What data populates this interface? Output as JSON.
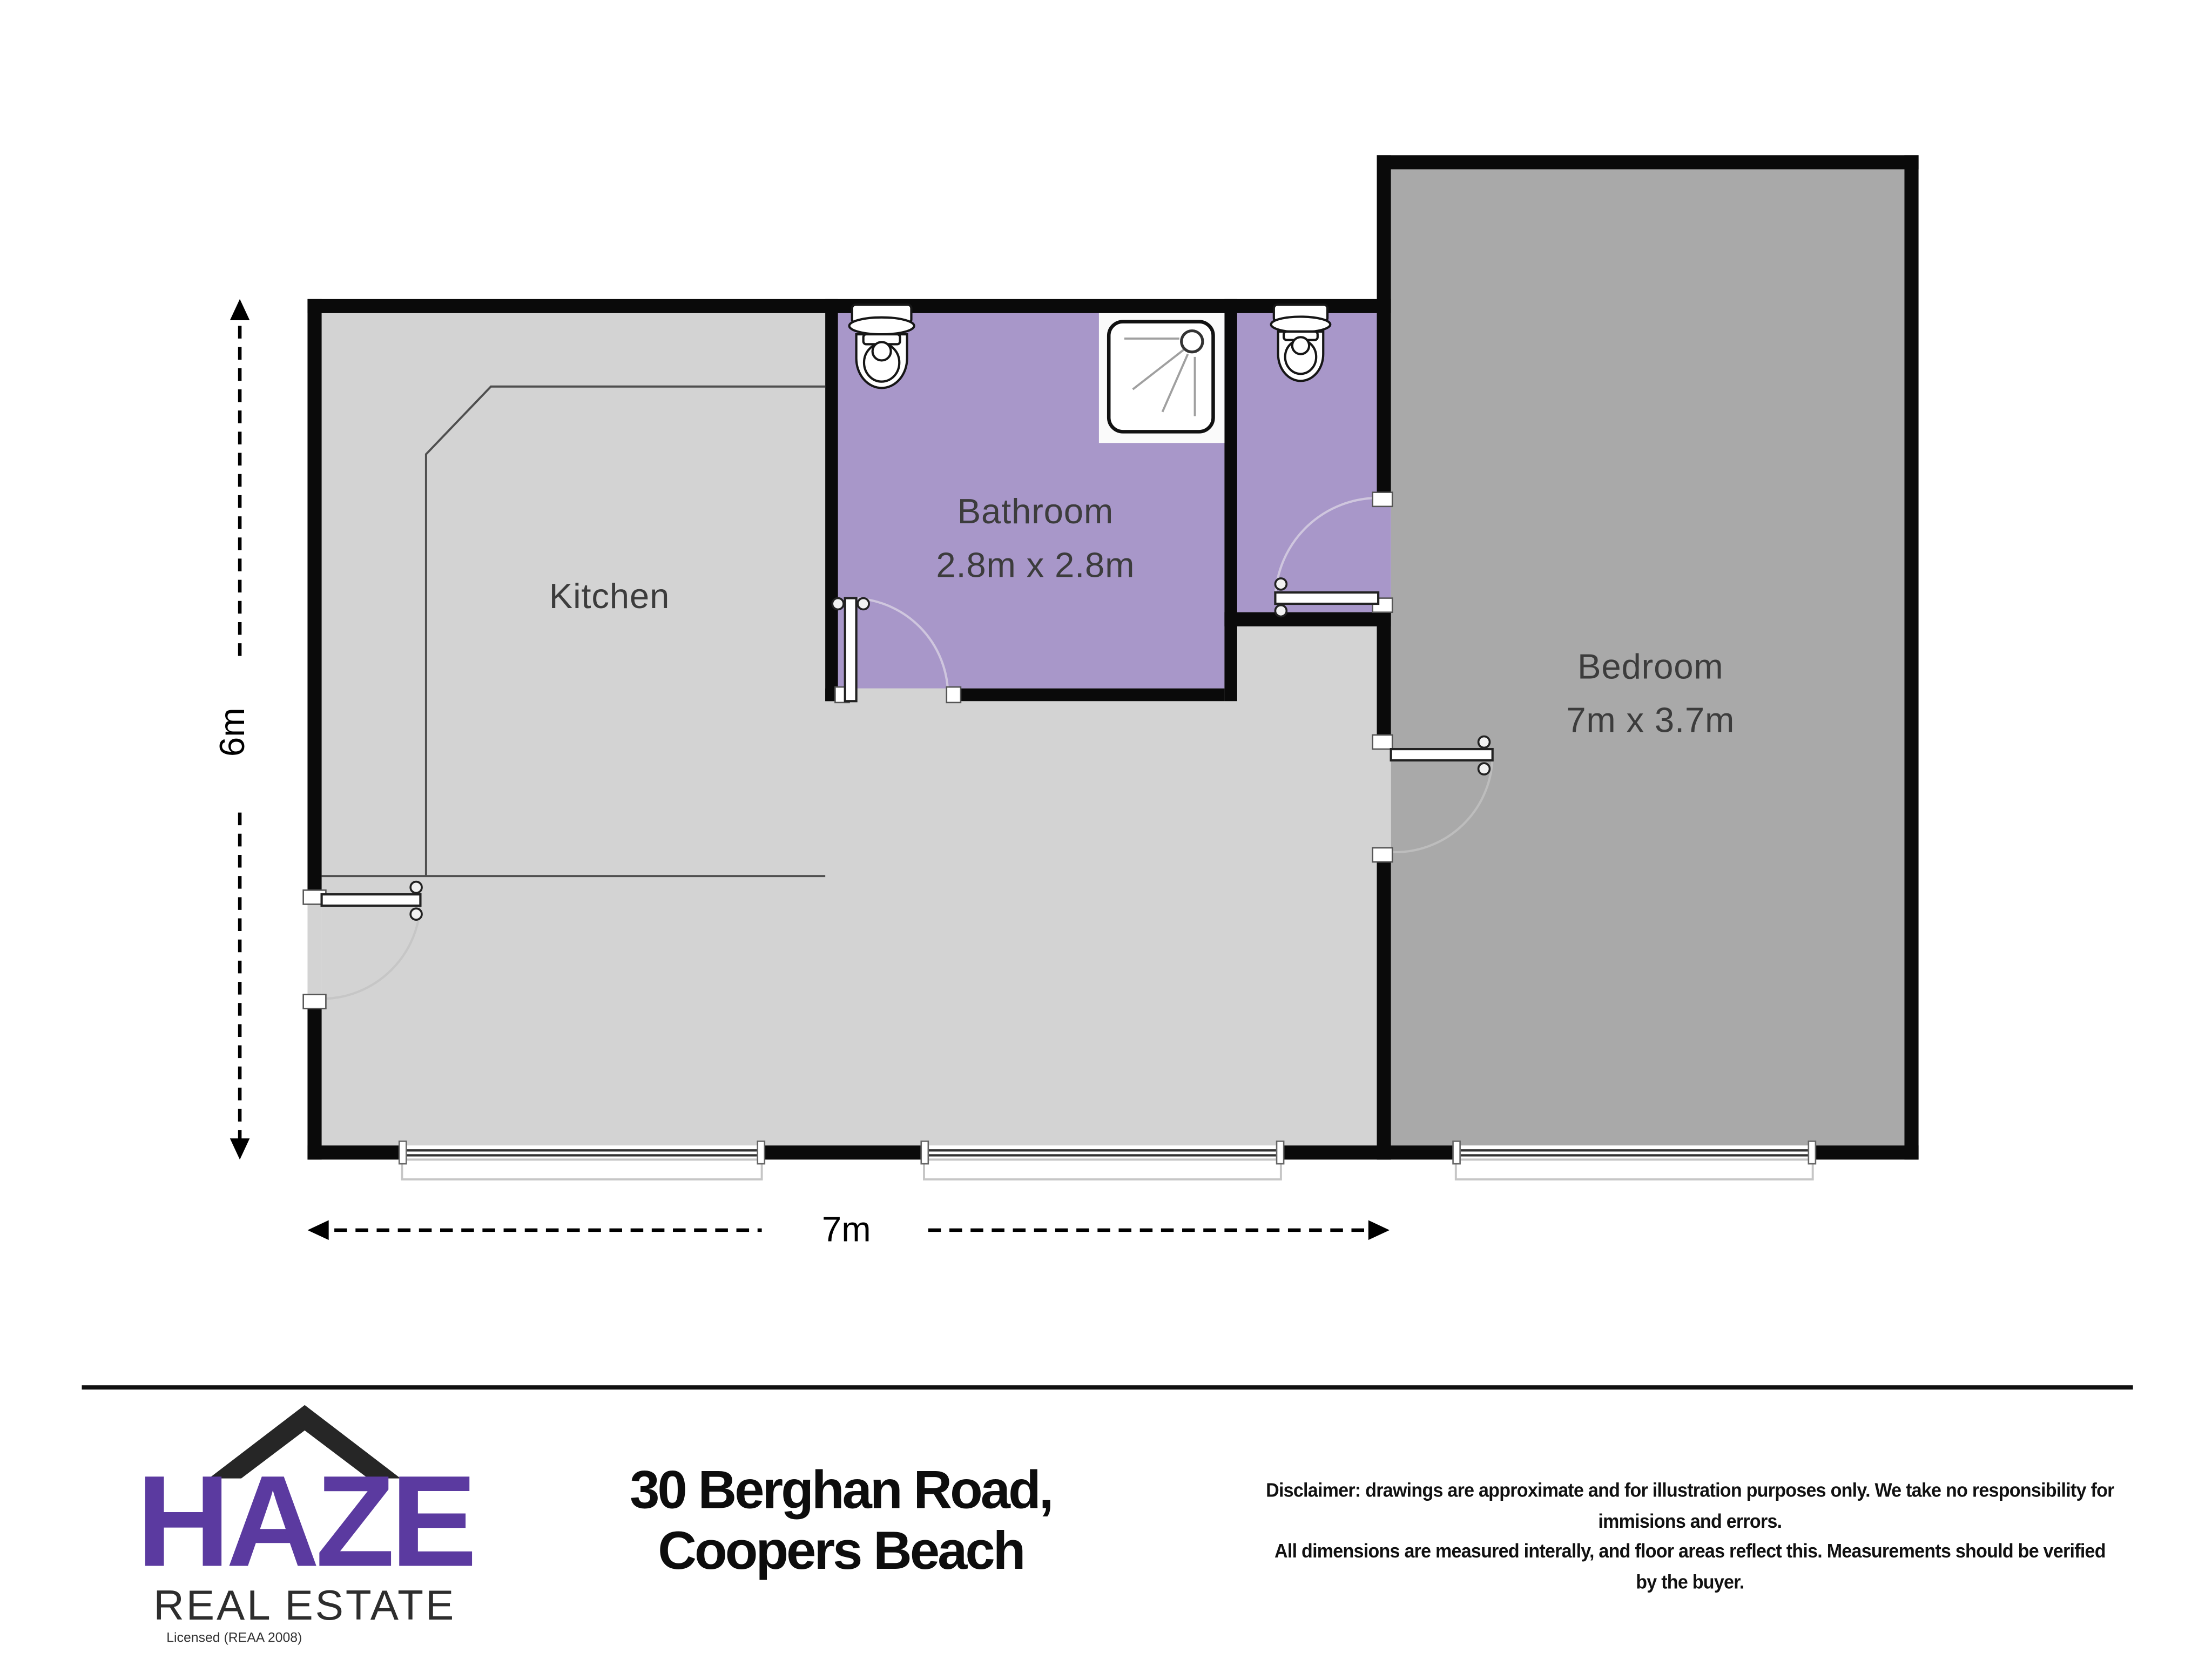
{
  "plan": {
    "rooms": [
      {
        "id": "kitchen",
        "label": "Kitchen",
        "dimensions": ""
      },
      {
        "id": "bathroom",
        "label": "Bathroom",
        "dimensions": "2.8m x 2.8m"
      },
      {
        "id": "bedroom",
        "label": "Bedroom",
        "dimensions": "7m x 3.7m"
      }
    ],
    "overall_dimensions": {
      "height_label": "6m",
      "width_label": "7m"
    },
    "fixtures": [
      "toilet",
      "shower",
      "toilet"
    ],
    "colors": {
      "wall": "#0a0a0a",
      "kitchen_floor": "#d3d3d3",
      "bedroom_floor": "#a9a9a9",
      "bathroom_floor": "#a897c9",
      "swing_arc": "#c9c2d6"
    }
  },
  "footer": {
    "brand": {
      "name": "HAZE",
      "tagline": "REAL ESTATE",
      "license": "Licensed (REAA 2008)",
      "accent_color": "#5b3aa0"
    },
    "address": {
      "line1": "30 Berghan Road,",
      "line2": "Coopers Beach"
    },
    "disclaimer": {
      "line1": "Disclaimer: drawings are approximate and for illustration purposes only. We take no responsibility for immisions and errors.",
      "line2": "All dimensions are measured interally, and floor areas reflect this. Measurements should be verified by the buyer."
    }
  }
}
